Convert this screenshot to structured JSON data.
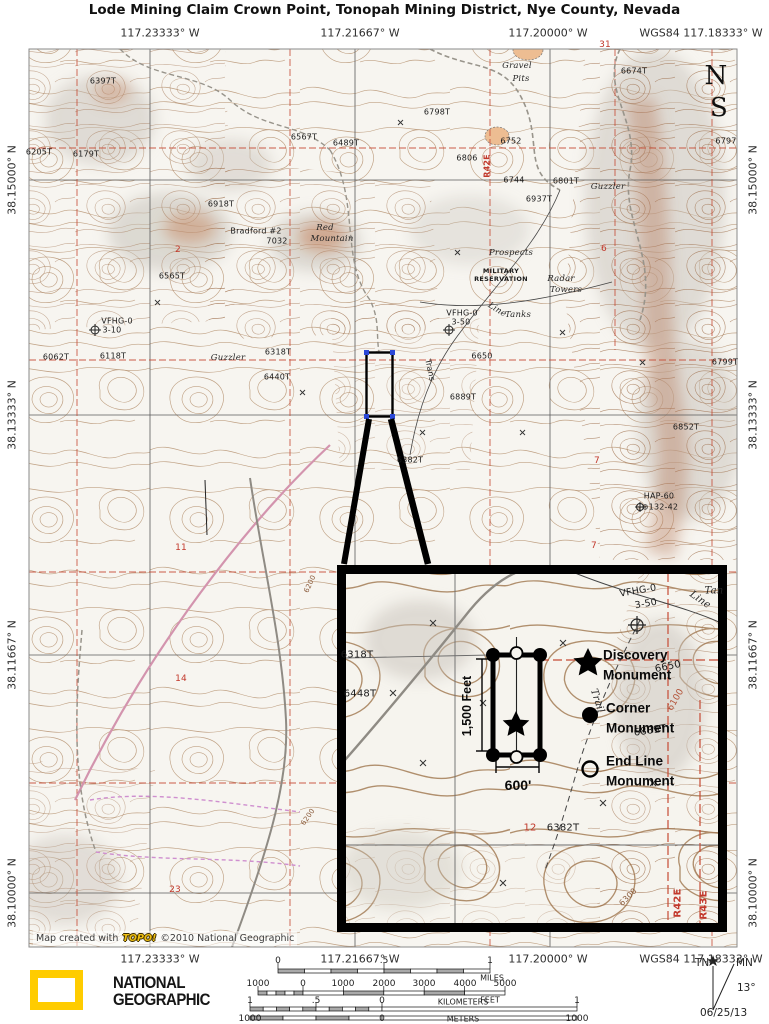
{
  "title": "Lode Mining Claim Crown Point, Tonopah Mining District, Nye County, Nevada",
  "coords": {
    "top": [
      "117.23333° W",
      "117.21667° W",
      "117.20000° W",
      "WGS84 117.18333° W"
    ],
    "bottom": [
      "117.23333° W",
      "117.21667° W",
      "117.20000° W",
      "WGS84 117.18333° W"
    ],
    "left": [
      "38.15000° N",
      "38.13333° N",
      "38.11667° N",
      "38.10000° N"
    ],
    "right": [
      "38.15000° N",
      "38.13333° N",
      "38.11667° N",
      "38.10000° N"
    ]
  },
  "map": {
    "labels": {
      "gravel1": "Gravel",
      "gravel2": "Pits",
      "e6397": "6397T",
      "e6205": "6205T",
      "e6179": "6179T",
      "e6567": "6567T",
      "e6489": "6489T",
      "e6918": "6918T",
      "bradford": "Bradford  #2",
      "e7032": "7032",
      "red1": "Red",
      "red2": "Mountain",
      "e6565": "6565T",
      "e6798": "6798T",
      "e6674": "6674T",
      "e6752": "6752",
      "e6806": "6806",
      "e6744": "6744",
      "e6801": "6801T",
      "e6937": "6937T",
      "e6797": "6797",
      "guzzler1": "Guzzler",
      "prospects": "Prospects",
      "mil1": "MILITARY",
      "mil2": "RESERVATION",
      "radar1": "Radar",
      "radar2": "Towers",
      "vfhg1a": "VFHG-0",
      "vfhg1b": "3-50",
      "mark1": "⊕",
      "tanks": "Tanks",
      "line": "Line",
      "trans": "Trans",
      "e6650": "6650",
      "e6889": "6889T",
      "e6382": "6382T",
      "vfhg2a": "VFHG-0",
      "vfhg2b": "3-10",
      "mark2": "⊕",
      "e6062": "6062T",
      "e6118": "6118T",
      "guzzler2": "Guzzler",
      "e6318": "6318T",
      "e6440": "6440T",
      "e6852": "6852T",
      "e6799": "6799T",
      "hap1": "HAP-60",
      "hap2": "⊕132-42",
      "c6200a": "6200",
      "c6200b": "6200",
      "bigN": "N",
      "bigS": "S",
      "r42e": "R42E"
    },
    "sections": {
      "s31": "31",
      "s6": "6",
      "s2": "2",
      "s7a": "7",
      "s7b": "7",
      "s11": "11",
      "s14": "14",
      "s23": "23"
    },
    "credit": {
      "prefix": "Map created with",
      "topo": "TOPO!",
      "suffix": "©2010 National Geographic"
    }
  },
  "inset": {
    "dims": {
      "height": "1,500 Feet",
      "width": "600'"
    },
    "legend": {
      "discovery1": "Discovery",
      "discovery2": "Monument",
      "corner1": "Corner",
      "corner2": "Monument",
      "endline1": "End Line",
      "endline2": "Monument"
    },
    "labels": {
      "vfhga": "VFHG-0",
      "vfhgb": "3-50",
      "line": "Line",
      "tan": "Tan",
      "e6318": "6318T",
      "e6448": "6448T",
      "e6650": "6650",
      "e6100": "6100",
      "e6889": "6889T",
      "trail": "Trail",
      "e6382": "6382T",
      "s12": "12",
      "e6300": "6300",
      "r42e": "R42E",
      "r43e": "R43E"
    }
  },
  "scale": {
    "miles": {
      "t0": "0",
      "t5": ".5",
      "t1": "1",
      "unit": "MILES"
    },
    "feet": {
      "m1000": "1000",
      "t0": "0",
      "t1": "1000",
      "t2": "2000",
      "t3": "3000",
      "t4": "4000",
      "t5": "5000",
      "unit": "FEET"
    },
    "km": {
      "l1": "1",
      "l5": ".5",
      "l0": "0",
      "unit": "KILOMETERS",
      "r1": "1"
    },
    "m": {
      "l1000": "1000",
      "l0": "0",
      "unit": "METERS",
      "r1000": "1000"
    }
  },
  "compass": {
    "tn": "TN",
    "mn": "MN",
    "angle": "13°",
    "date": "06/25/13"
  },
  "logo": {
    "line1": "NATIONAL",
    "line2": "GEOGRAPHIC"
  }
}
